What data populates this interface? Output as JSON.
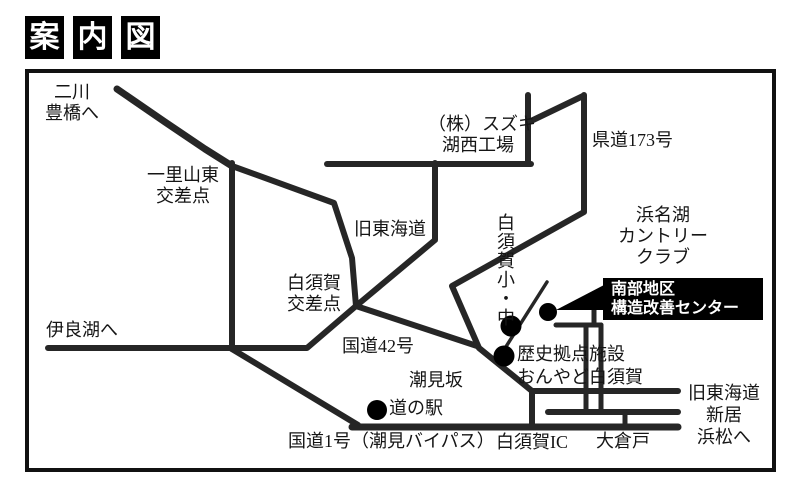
{
  "title": {
    "chars": [
      "案",
      "内",
      "図"
    ]
  },
  "map": {
    "labels": {
      "futagawa": [
        "二川",
        "豊橋へ"
      ],
      "ichiriyama": [
        "一里山東",
        "交差点"
      ],
      "suzuki": [
        "（株）スズキ",
        "湖西工場"
      ],
      "kendo173": "県道173号",
      "hamanako_cc": [
        "浜名湖",
        "カントリー",
        "クラブ"
      ],
      "kyu_tokaido": "旧東海道",
      "shirasuka_crossing": [
        "白須賀",
        "交差点"
      ],
      "irago": "伊良湖へ",
      "kokudo42": "国道42号",
      "shirasuka_school": "白須賀小・中",
      "shiomizaka": "潮見坂",
      "rekishi": [
        "歴史拠点施設",
        "おんやど白須賀"
      ],
      "michinoeki": "道の駅",
      "kokudo1": "国道1号（潮見バイパス）",
      "shirasuka_ic": "白須賀IC",
      "okurado": "大倉戸",
      "kyu_tokaido_east": [
        "旧東海道",
        "新居",
        "浜松へ"
      ],
      "center_facility": [
        "南部地区",
        "構造改善センター"
      ]
    },
    "colors": {
      "road": "#262626",
      "ink": "#111111",
      "facility_box_bg": "#000000",
      "facility_box_text": "#ffffff"
    }
  }
}
